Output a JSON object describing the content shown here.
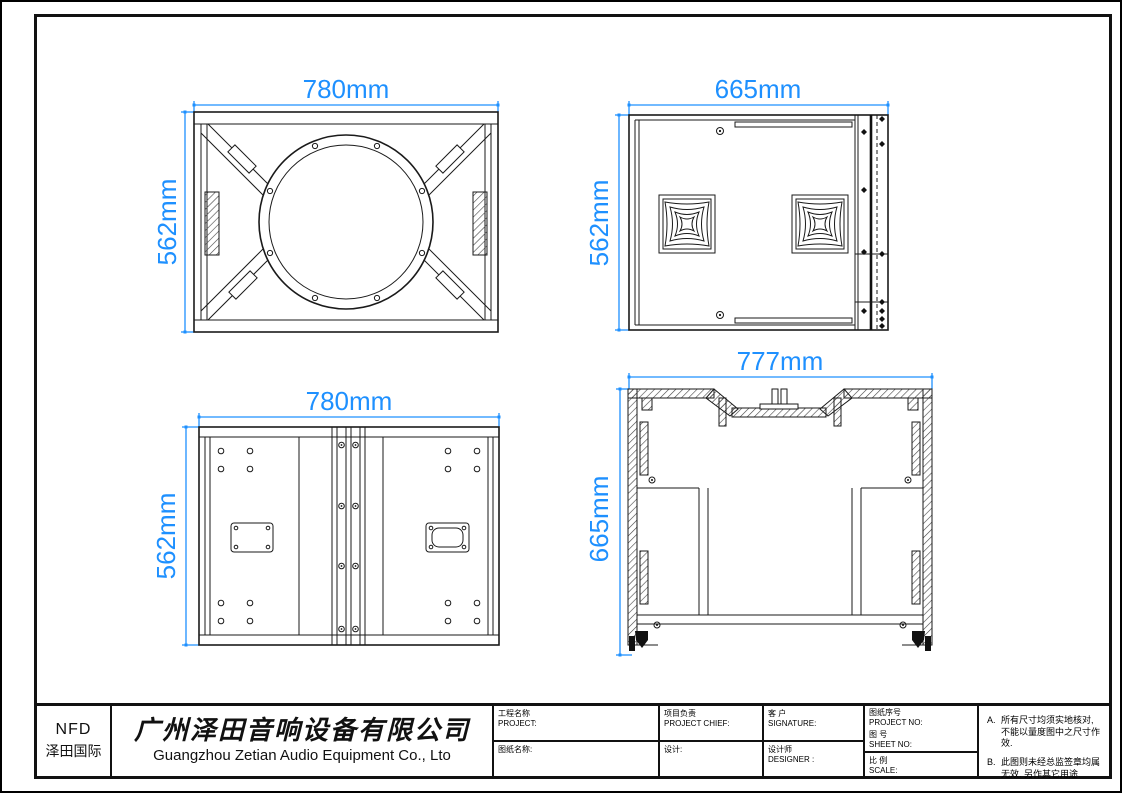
{
  "colors": {
    "dimension_blue": "#1E90FF",
    "line_black": "#1a1a1a"
  },
  "views": {
    "front": {
      "width_label": "780mm",
      "height_label": "562mm"
    },
    "side": {
      "width_label": "665mm",
      "height_label": "562mm"
    },
    "rear": {
      "width_label": "780mm",
      "height_label": "562mm"
    },
    "section": {
      "width_label": "777mm",
      "height_label": "665mm"
    }
  },
  "title_block": {
    "logo_line1": "NFD",
    "logo_line2": "泽田国际",
    "company_zh": "广州泽田音响设备有限公司",
    "company_en": "Guangzhou Zetian Audio Equipment Co., Lto",
    "fields": {
      "project_zh": "工程名称",
      "project_en": "PROJECT:",
      "chief_zh": "项目负责",
      "chief_en": "PROJECT CHIEF:",
      "client_zh": "客 户",
      "client_en": "SIGNATURE:",
      "project_no_zh": "图纸序号",
      "project_no_en": "PROJECT NO:",
      "sheet_no_zh": "图  号",
      "sheet_no_en": "SHEET  NO:",
      "drawing_name_zh": "图纸名称:",
      "design_zh": "设计:",
      "designer_zh": "设计师",
      "designer_en": "DESIGNER :",
      "scale_zh": "比  例",
      "scale_en": "SCALE:"
    },
    "notes": [
      {
        "id": "A.",
        "text": "所有尺寸均须实地核对, 不能以量度图中之尺寸作效."
      },
      {
        "id": "B.",
        "text": "此图则未经总监签章均属无效. 另作其它用途."
      }
    ]
  }
}
